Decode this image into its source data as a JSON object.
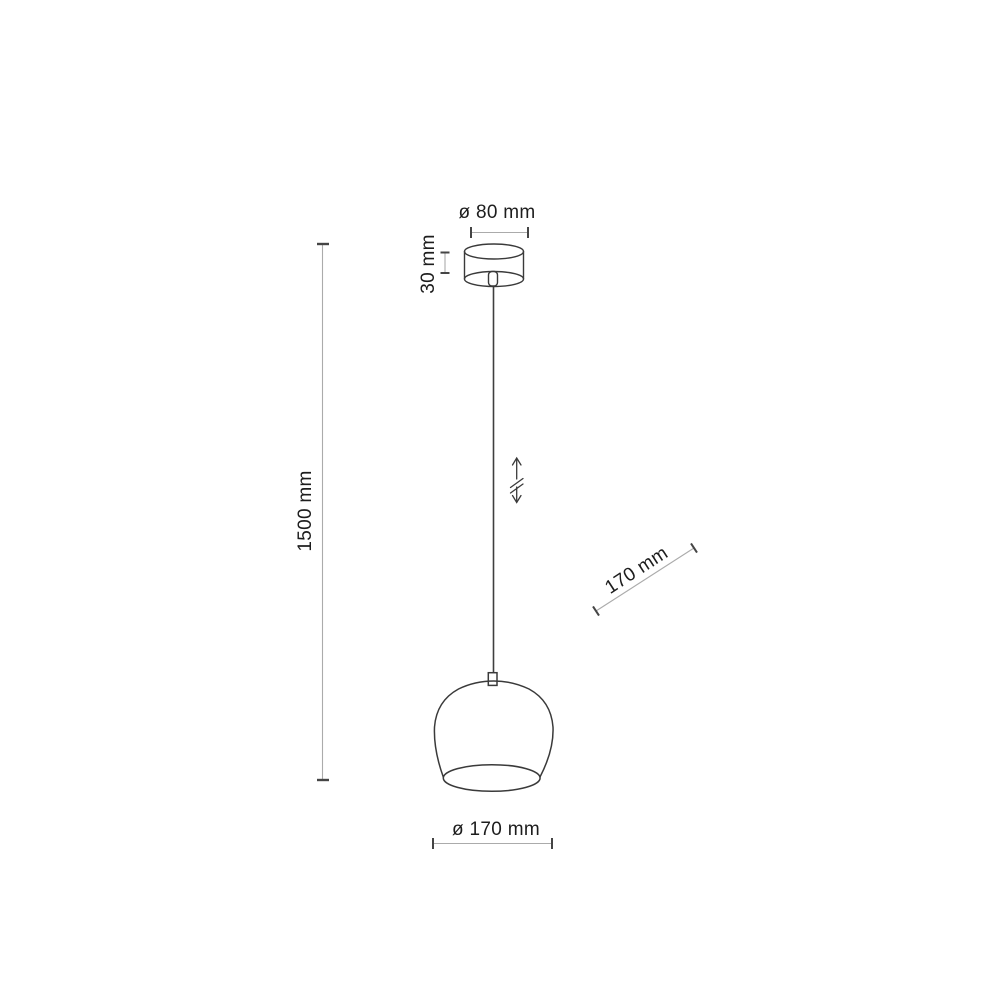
{
  "diagram": {
    "title": "pendant-lamp-dimension-drawing",
    "labels": {
      "canopy_diameter": "ø 80 mm",
      "canopy_height": "30 mm",
      "suspension_height": "1500 mm",
      "shade_height_diagonal": "170 mm",
      "shade_diameter": "ø 170 mm"
    },
    "icons": {
      "height_adjust": "double-vertical-arrow-with-break"
    },
    "colors": {
      "background": "#ffffff",
      "outline": "#3a3a3a",
      "dimension_line": "#ababab",
      "dimension_tick": "#454545",
      "text": "#1d1d1d"
    }
  }
}
